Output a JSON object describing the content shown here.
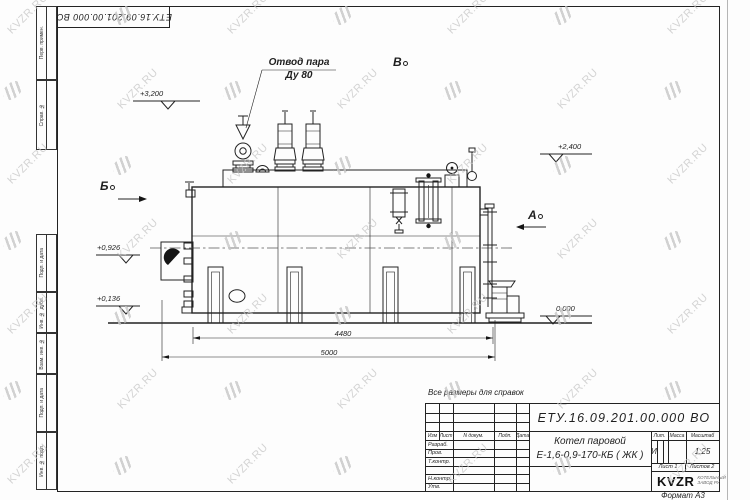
{
  "watermark": {
    "text": "KVZR.RU",
    "color": "#c6c6c6",
    "cols": [
      2,
      112,
      222,
      332,
      442,
      552,
      662
    ],
    "rows": [
      8,
      83,
      158,
      233,
      308,
      383,
      458
    ]
  },
  "stamp": {
    "designation": "ЕТУ.16.09.201.00.000 ВО"
  },
  "frame": {
    "side_labels": [
      "Перв. примен.",
      "Справ. №",
      "Подп. и дата",
      "Инв. № дубл.",
      "Взам. инв. №",
      "Подп. и дата",
      "Инв. № подл."
    ]
  },
  "drawing": {
    "note": "Все размеры для справок",
    "labels": {
      "steam_outlet_1": "Отвод пара",
      "steam_outlet_2": "Ду 80",
      "view_top": "В",
      "view_left": "Б",
      "view_right": "А",
      "elev_top": "+3,200",
      "elev_right": "+2,400",
      "elev_burner": "+0,926",
      "elev_low": "+0,136",
      "elev_zero": "0,000",
      "dim_inner": "4480",
      "dim_outer": "5000"
    }
  },
  "title_block": {
    "designation": "ЕТУ.16.09.201.00.000  ВО",
    "product_name_1": "Котел паровой",
    "product_name_2": "Е-1,6-0,9-170-КБ ( ЖК )",
    "cols": {
      "izm": "Изм",
      "list": "Лист",
      "doc": "N докум.",
      "podp": "Подп.",
      "data": "Дата"
    },
    "rows": [
      "Разраб.",
      "Пров.",
      "Т.контр.",
      "Н.контр.",
      "Утв."
    ],
    "headers": {
      "lit": "Лит.",
      "mass": "Масса",
      "scale": "Масштаб"
    },
    "lit_value": "И",
    "scale_value": "1:25",
    "sheet": "Лист 1",
    "sheets": "Листов 2",
    "logo_text": "KVZR",
    "logo_sub_1": "КОТЕЛЬНЫЙ",
    "logo_sub_2": "ЗАВОД РУ",
    "format": "Формат А3"
  }
}
